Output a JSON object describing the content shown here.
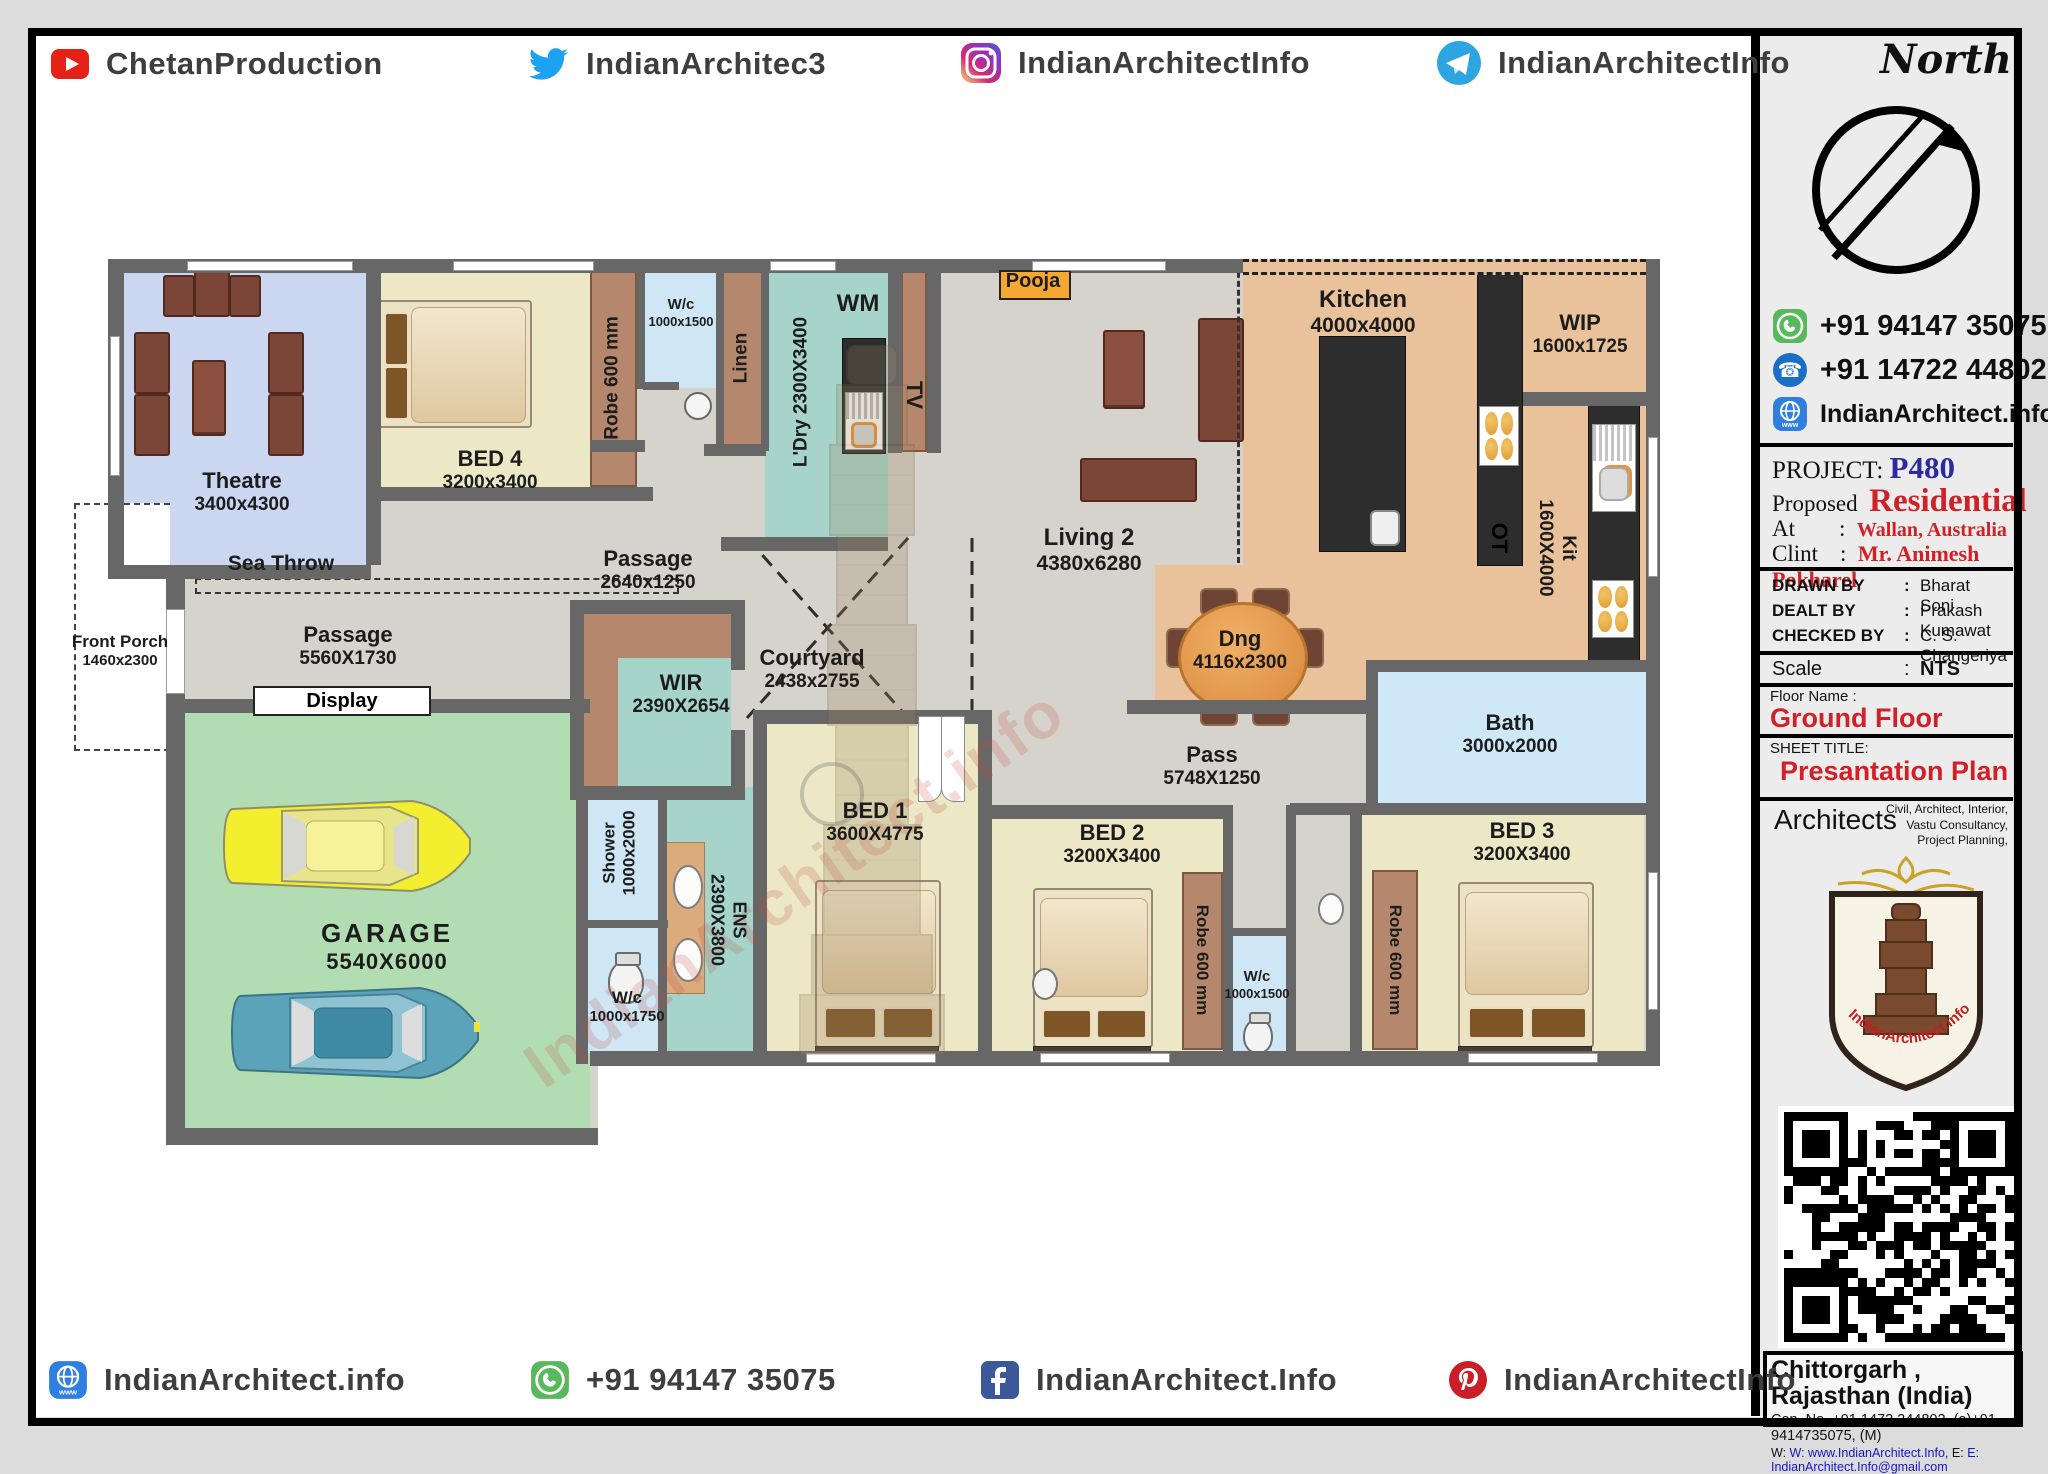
{
  "header": {
    "social": [
      {
        "icon": "youtube-icon",
        "label": "ChetanProduction"
      },
      {
        "icon": "twitter-icon",
        "label": "IndianArchitec3"
      },
      {
        "icon": "instagram-icon",
        "label": "IndianArchitectInfo"
      },
      {
        "icon": "telegram-icon",
        "label": "IndianArchitectInfo"
      }
    ]
  },
  "footer": {
    "social": [
      {
        "icon": "globe-icon",
        "label": "IndianArchitect.info"
      },
      {
        "icon": "whatsapp-icon",
        "label": "+91 94147 35075"
      },
      {
        "icon": "facebook-icon",
        "label": "IndianArchitect.Info"
      },
      {
        "icon": "pinterest-icon",
        "label": "IndianArchitectInfo"
      }
    ]
  },
  "sidebar": {
    "north_label": "North",
    "contacts": [
      {
        "icon": "whatsapp-icon",
        "value": "+91 94147 35075"
      },
      {
        "icon": "phone-icon",
        "value": "+91 14722 44802"
      },
      {
        "icon": "globe-icon",
        "value": "IndianArchitect.info"
      }
    ],
    "project_label": "PROJECT:",
    "project_code": "P480",
    "proposed_label": "Proposed",
    "proposed_value": "Residential",
    "at_label": "At",
    "at_sep": ":",
    "at_value": "Wallan, Australia",
    "client_label": "Clint",
    "client_sep": ":",
    "client_value": "Mr. Animesh Pokharel",
    "rows": [
      {
        "label": "DRAWN BY",
        "sep": ":",
        "value": "Bharat Soni"
      },
      {
        "label": "DEALT BY",
        "sep": ":",
        "value": "Prakash Kumawat"
      },
      {
        "label": "CHECKED BY",
        "sep": ":",
        "value": "C. S. Changeriya"
      }
    ],
    "scale_label": "Scale",
    "scale_sep": ":",
    "scale_value": "NTS",
    "floor_name_label": "Floor Name :",
    "floor_name": "Ground Floor",
    "sheet_title_label": "SHEET TITLE:",
    "sheet_title": "Presantation Plan",
    "architects_label": "Architects",
    "services": "Civil, Architect, Interior, Vastu Consultancy, Project Planning,",
    "logo_text": "IndianArchitect.info",
    "address_line1": "Chittorgarh , Rajasthan (India)",
    "address_line2": "Con. No. +91 1472 244802, (o)+91 9414735075, (M)",
    "address_line3_w": "W: www.IndianArchitect.Info,",
    "address_line3_e": "E: IndianArchitect.Info@gmail.com"
  },
  "plan": {
    "watermark": "IndianArchitect.info",
    "rooms": {
      "theatre": {
        "name": "Theatre",
        "dims": "3400x4300"
      },
      "sea_throw": {
        "name": "Sea Throw"
      },
      "front_porch": {
        "name": "Front Porch",
        "dims": "1460x2300"
      },
      "bed4": {
        "name": "BED 4",
        "dims": "3200x3400"
      },
      "robe4": {
        "name": "Robe 600 mm"
      },
      "wc_top": {
        "name": "W/c",
        "dims": "1000x1500"
      },
      "linen": {
        "name": "Linen"
      },
      "ldry": {
        "name": "L'Dry",
        "dims": "2300X3400"
      },
      "wm": {
        "name": "WM"
      },
      "tv": {
        "name": "TV"
      },
      "pooja": {
        "name": "Pooja"
      },
      "living": {
        "name": "Living 2",
        "dims": "4380x6280"
      },
      "kitchen": {
        "name": "Kitchen",
        "dims": "4000x4000"
      },
      "wip": {
        "name": "WIP",
        "dims": "1600x1725"
      },
      "ot": {
        "name": "OT"
      },
      "kit": {
        "name": "Kit",
        "dims": "1600X4000"
      },
      "passage1": {
        "name": "Passage",
        "dims": "2640x1250"
      },
      "passage2": {
        "name": "Passage",
        "dims": "5560X1730"
      },
      "display": {
        "name": "Display"
      },
      "courtyard": {
        "name": "Courtyard",
        "dims": "2438x2755"
      },
      "wir": {
        "name": "WIR",
        "dims": "2390X2654"
      },
      "garage": {
        "name": "GARAGE",
        "dims": "5540X6000"
      },
      "shower": {
        "name": "Shower",
        "dims": "1000x2000"
      },
      "wc_bl": {
        "name": "W/c",
        "dims": "1000x1750"
      },
      "ens": {
        "name": "ENS",
        "dims": "2390X3800"
      },
      "bed1": {
        "name": "BED 1",
        "dims": "3600X4775"
      },
      "bed2": {
        "name": "BED 2",
        "dims": "3200X3400"
      },
      "robe2": {
        "name": "Robe 600 mm"
      },
      "wc_bm": {
        "name": "W/c",
        "dims": "1000x1500"
      },
      "bed3": {
        "name": "BED 3",
        "dims": "3200X3400"
      },
      "robe3": {
        "name": "Robe 600 mm"
      },
      "dng": {
        "name": "Dng",
        "dims": "4116x2300"
      },
      "pass": {
        "name": "Pass",
        "dims": "5748X1250"
      },
      "bath": {
        "name": "Bath",
        "dims": "3000x2000"
      }
    }
  },
  "colors": {
    "wall": "#676767",
    "floor": "#d6d2cc",
    "bedroom": "#ece8c6",
    "teal": "#a6d4cb",
    "light_blue": "#cfe6f5",
    "kitchen_tan": "#e9c29c",
    "robe_brown": "#b5886d",
    "garage_green": "#b2ddb2",
    "pooja_orange": "#f5a733",
    "accent_red": "#cf2127",
    "accent_blue": "#2b2b9e"
  }
}
